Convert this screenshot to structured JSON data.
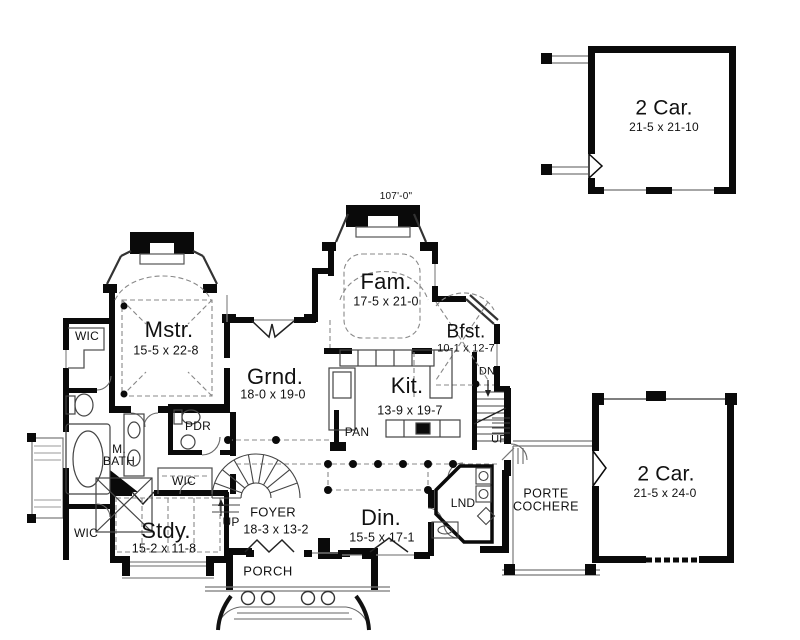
{
  "plan": {
    "type": "first-floor-plan",
    "overall_dimension": "107'-0\""
  },
  "rooms": [
    {
      "id": "garage-top",
      "name": "2 Car.",
      "dims": "21-5 x 21-10"
    },
    {
      "id": "family",
      "name": "Fam.",
      "dims": "17-5 x 21-0"
    },
    {
      "id": "breakfast",
      "name": "Bfst.",
      "dims": "10-1 x 12-7"
    },
    {
      "id": "master",
      "name": "Mstr.",
      "dims": "15-5 x 22-8"
    },
    {
      "id": "grand",
      "name": "Grnd.",
      "dims": "18-0 x 19-0"
    },
    {
      "id": "kitchen",
      "name": "Kit.",
      "dims": "13-9 x 19-7"
    },
    {
      "id": "garage-right",
      "name": "2 Car.",
      "dims": "21-5 x 24-0"
    },
    {
      "id": "study",
      "name": "Stdy.",
      "dims": "15-2 x 11-8"
    },
    {
      "id": "foyer",
      "name": "FOYER",
      "dims": "18-3 x 13-2"
    },
    {
      "id": "dining",
      "name": "Din.",
      "dims": "15-5 x 17-1"
    }
  ],
  "annotations": [
    {
      "id": "wic-upper",
      "label": "WIC"
    },
    {
      "id": "wic-mid",
      "label": "WIC"
    },
    {
      "id": "wic-lower",
      "label": "WIC"
    },
    {
      "id": "master-bath",
      "label": "M. BATH"
    },
    {
      "id": "powder-room",
      "label": "PDR"
    },
    {
      "id": "pantry",
      "label": "PAN"
    },
    {
      "id": "stairs-down",
      "label": "DN"
    },
    {
      "id": "stairs-up",
      "label": "UP"
    },
    {
      "id": "foyer-stair-up",
      "label": "UP"
    },
    {
      "id": "laundry",
      "label": "LND"
    },
    {
      "id": "porte-cochere",
      "label": "PORTE COCHERE"
    },
    {
      "id": "porch",
      "label": "PORCH"
    }
  ],
  "colors": {
    "wall": "#0a0a0a",
    "paper": "#ffffff",
    "thin_line": "#666666"
  }
}
